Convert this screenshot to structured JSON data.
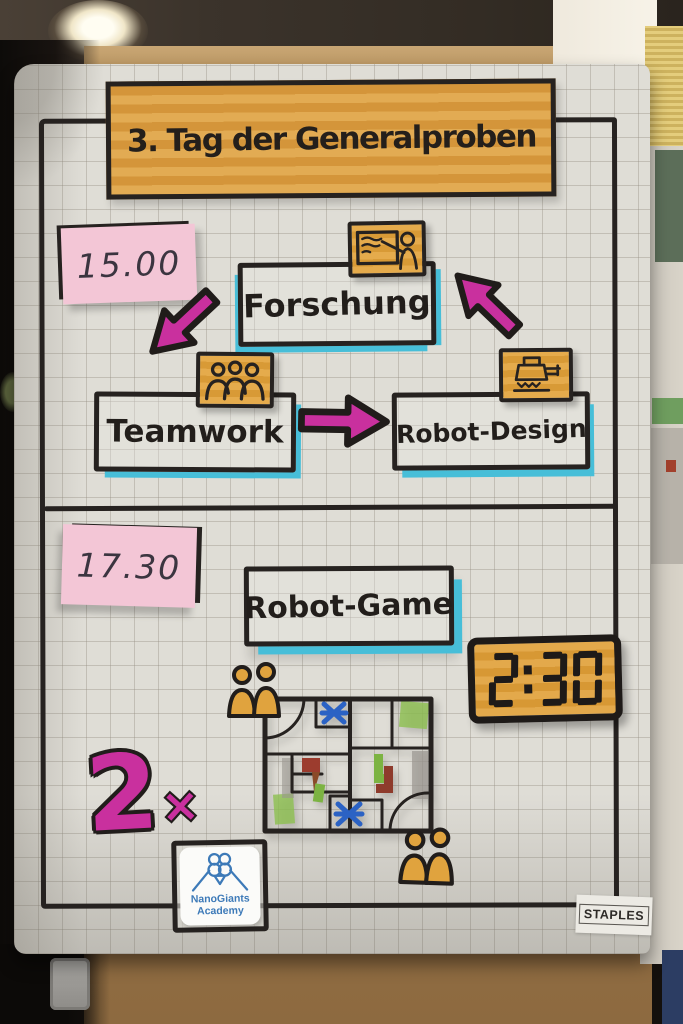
{
  "poster": {
    "title": "3. Tag der Generalproben",
    "session1": {
      "time": "15.00",
      "stations": {
        "forschung": {
          "label": "Forschung",
          "icon": "presentation-board-icon"
        },
        "teamwork": {
          "label": "Teamwork",
          "icon": "three-people-icon"
        },
        "robot_design": {
          "label": "Robot-Design",
          "icon": "robot-icon"
        }
      },
      "arrow_icons": [
        "arrow-down-left",
        "arrow-right",
        "arrow-up-left"
      ]
    },
    "session2": {
      "time": "17.30",
      "station": {
        "label": "Robot-Game"
      },
      "timer": "2:30",
      "multiplier": {
        "value": "2",
        "symbol": "×"
      },
      "drawing_icons": [
        "robot-game-mat-drawing",
        "two-figures-icon",
        "two-figures-icon"
      ]
    },
    "footer": {
      "sticker": {
        "line1": "NanoGiants",
        "line2": "Academy",
        "icon": "nanogiants-owl-logo"
      },
      "paper_brand": "STAPLES"
    }
  },
  "scene_icons": [
    "ceiling-light",
    "door-hinge"
  ],
  "colors": {
    "marker_black": "#262220",
    "banner_orange": "#dd9f44",
    "icon_orange": "#e0a33e",
    "sticky_pink": "#f3c6d6",
    "arrow_magenta": "#c9309e",
    "shadow_cyan": "#47bed8",
    "logo_blue": "#3d7ab8",
    "paper_grey": "#dfddd6"
  }
}
